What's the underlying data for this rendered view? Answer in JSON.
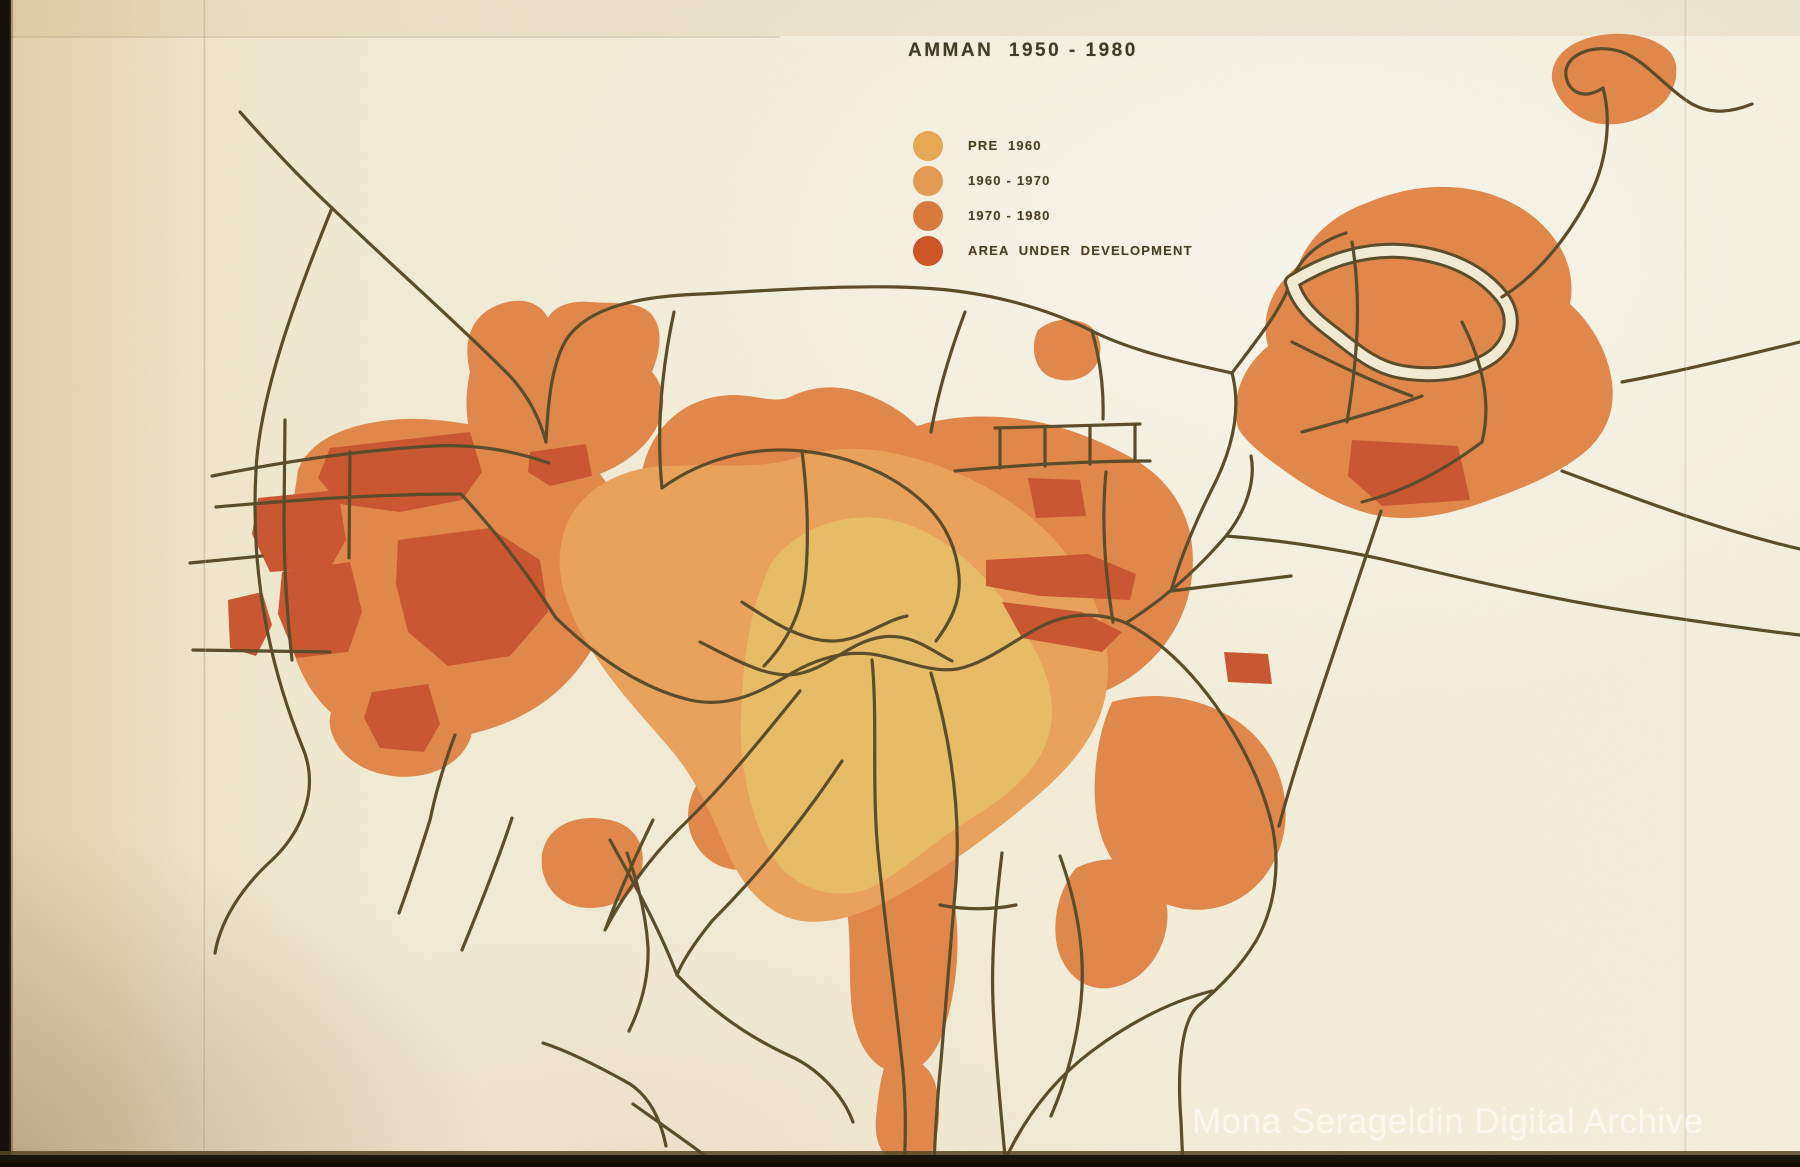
{
  "slide": {
    "title": "AMMAN  1950 - 1980",
    "watermark": "Mona Serageldin Digital Archive"
  },
  "legend": {
    "items": [
      {
        "label": "PRE  1960",
        "color": "#e6a852"
      },
      {
        "label": "1960 - 1970",
        "color": "#e39a52"
      },
      {
        "label": "1970 - 1980",
        "color": "#d87a3c"
      },
      {
        "label": "AREA  UNDER  DEVELOPMENT",
        "color": "#cd5426"
      }
    ]
  },
  "map": {
    "colors": {
      "paper": "#f3ecd6",
      "pre_1960": "#e9bd67",
      "y1960_1970": "#eba25b",
      "y1970_1980": "#e2874a",
      "development": "#ca5530",
      "road": "#594a28"
    }
  }
}
